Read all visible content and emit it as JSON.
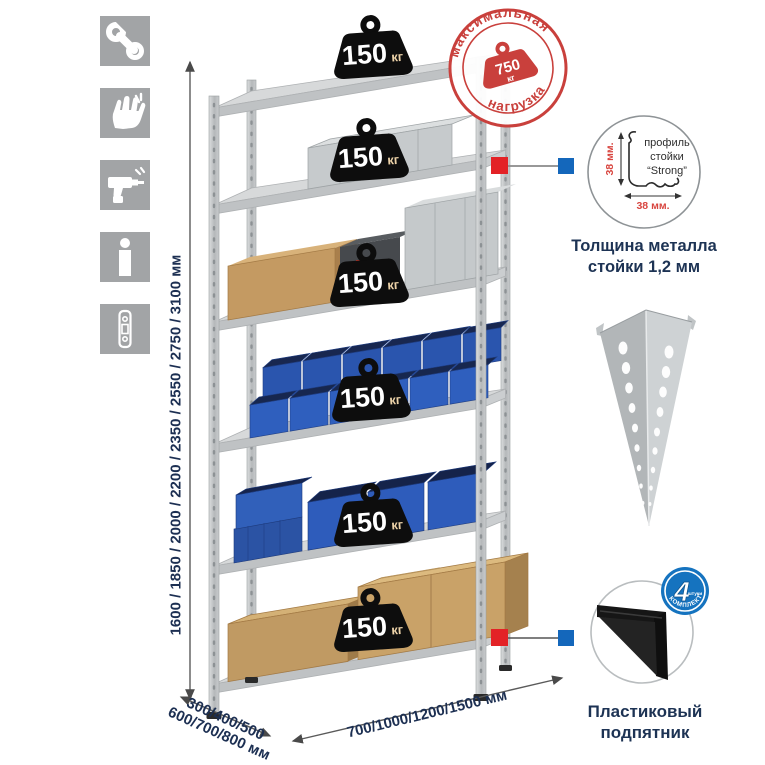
{
  "sidebar": {
    "icons": [
      {
        "name": "wrench-icon"
      },
      {
        "name": "gloves-icon"
      },
      {
        "name": "drill-icon"
      },
      {
        "name": "person-icon"
      },
      {
        "name": "rack-profile-icon"
      }
    ]
  },
  "dimensions": {
    "height": "1600 / 1850 / 2000 / 2200 / 2350 / 2550 / 2750 / 3100 мм",
    "depth_line1": "300/400/500",
    "depth_line2": "600/700/800 мм",
    "width": "700/1000/1200/1500 мм"
  },
  "stamp": {
    "arc_top": "максимальная",
    "arc_bottom": "нагрузка",
    "value": "750",
    "unit": "кг"
  },
  "shelf_weights": [
    {
      "value": "150",
      "unit": "кг"
    },
    {
      "value": "150",
      "unit": "кг"
    },
    {
      "value": "150",
      "unit": "кг"
    },
    {
      "value": "150",
      "unit": "кг"
    },
    {
      "value": "150",
      "unit": "кг"
    },
    {
      "value": "150",
      "unit": "кг"
    }
  ],
  "callouts": {
    "profile": {
      "label_line1": "профиль",
      "label_line2": "стойки",
      "label_line3": "“Strong”",
      "dim_vertical": "38 мм.",
      "dim_horizontal": "38 мм.",
      "caption_line1": "Толщина металла",
      "caption_line2": "стойки 1,2 мм"
    },
    "foot": {
      "badge_value": "4",
      "badge_small": "штуки",
      "badge_arc": "В КОМПЛЕКТЕ",
      "caption_line1": "Пластиковый",
      "caption_line2": "подпятник"
    }
  },
  "colors": {
    "tile_gray": "#a2a4a6",
    "metal_light": "#d7d9da",
    "metal_mid": "#bfc2c4",
    "bin_blue": "#2e5cbb",
    "cardboard": "#c49a62",
    "weight_black": "#0d0d0d",
    "stamp_red": "#c9403c",
    "accent_red": "#e32226",
    "accent_blue": "#1467bb",
    "dim_text_navy": "#1c2f52"
  }
}
